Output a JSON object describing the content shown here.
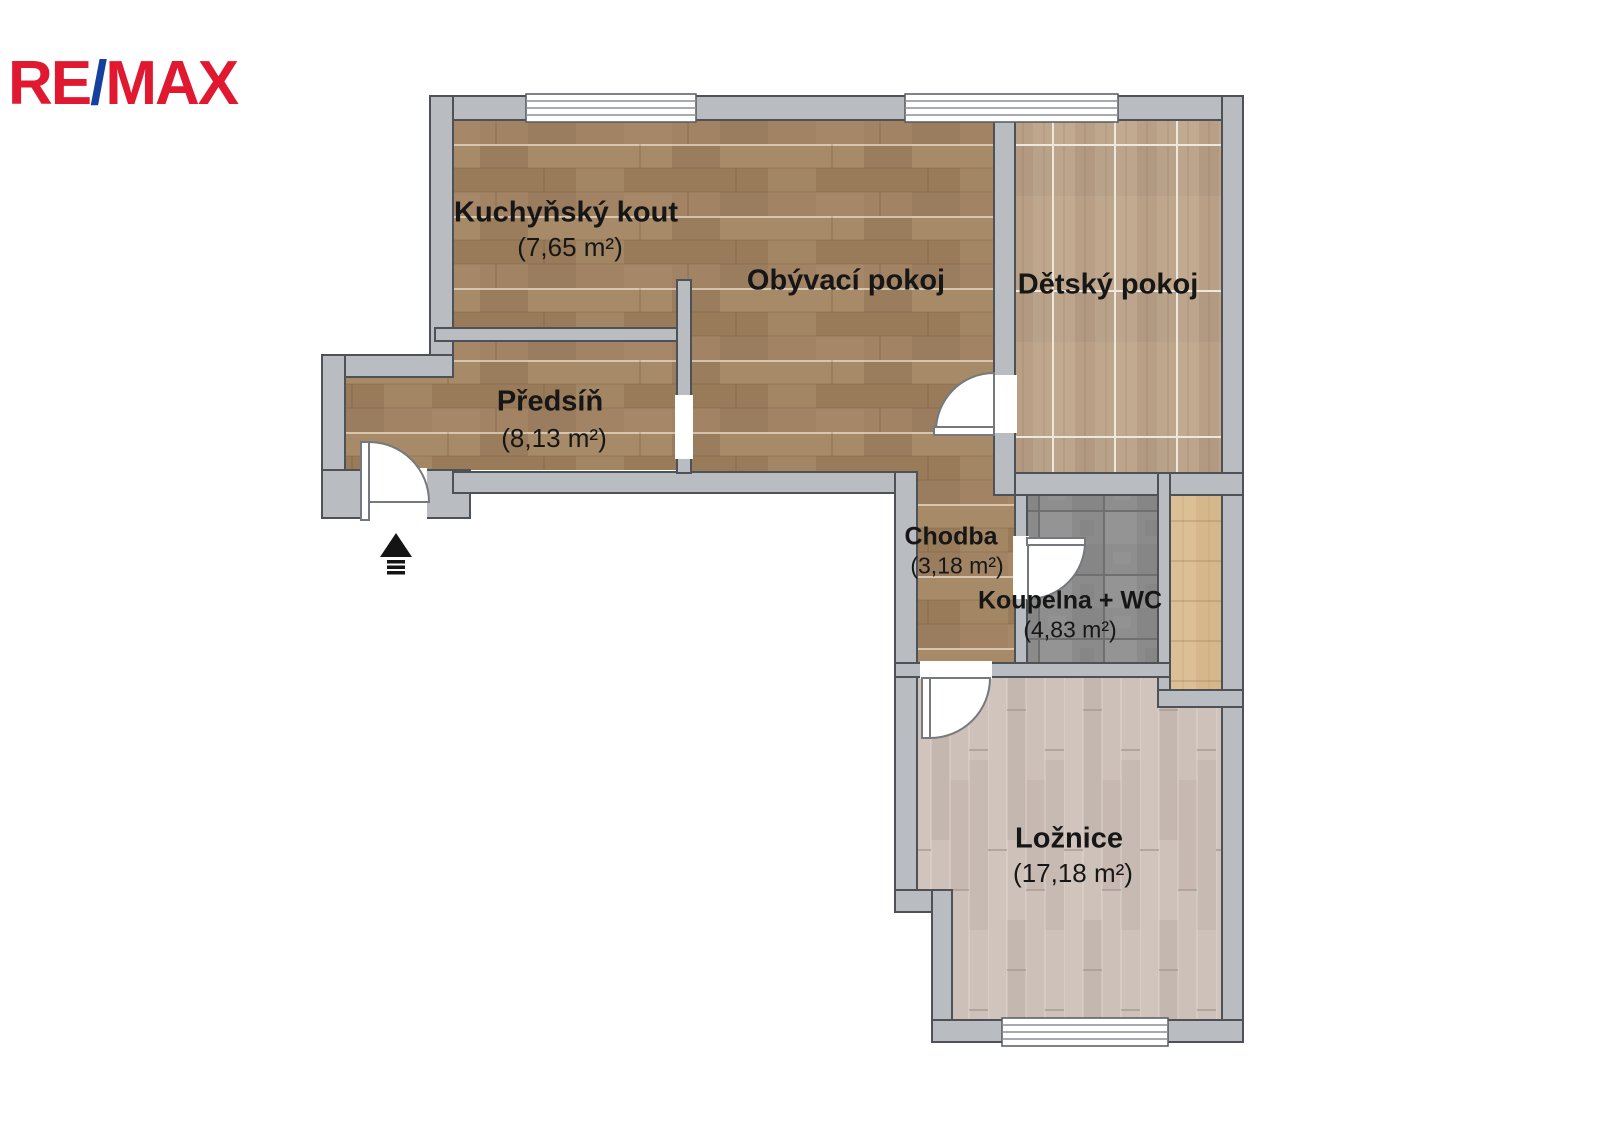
{
  "logo": {
    "part1": "RE",
    "slash": "/",
    "part2": "MAX"
  },
  "rooms": {
    "kitchen": {
      "name": "Kuchyňský kout",
      "area": "(7,65 m²)"
    },
    "living": {
      "name": "Obývací pokoj"
    },
    "children": {
      "name": "Dětský pokoj"
    },
    "hall": {
      "name": "Předsíň",
      "area": "(8,13 m²)"
    },
    "corridor": {
      "name": "Chodba",
      "area": "(3,18 m²)"
    },
    "bathroom": {
      "name": "Koupelna + WC",
      "area": "(4,83 m²)"
    },
    "bedroom": {
      "name": "Ložnice",
      "area": "(17,18 m²)"
    }
  },
  "colors": {
    "logo_red": "#e01931",
    "logo_blue": "#15409f",
    "wall_fill": "#b9bcc1",
    "wall_outline": "#4e5156",
    "floor_brown": "#a08162",
    "floor_children": "#bfa78e",
    "floor_bath": "#8e8e8e",
    "floor_strip": "#ddbf96",
    "floor_bedroom": "#cabcb4"
  }
}
